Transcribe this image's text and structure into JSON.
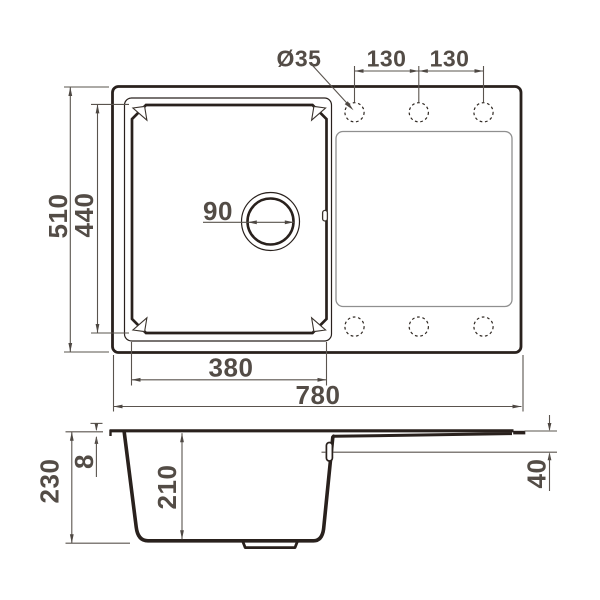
{
  "drawing": {
    "type": "technical-dimension-drawing",
    "subject": "kitchen sink with bowl and drainboard, plan view and section view",
    "colors": {
      "outline": "#29211d",
      "dimension_lines": "#5a544e",
      "dimension_text": "#534c46",
      "drainboard_line": "#8f8f8f",
      "background": "#ffffff"
    },
    "plan_view": {
      "labels": {
        "hole_diameter": "Ø35",
        "hole_spacing_left": "130",
        "hole_spacing_right": "130",
        "overall_width": "510",
        "bowl_inner_width": "440",
        "drain_diameter": "90",
        "bowl_outer_length": "380",
        "overall_length": "780"
      },
      "faucet_holes": {
        "rows": 2,
        "holes_per_row": 3
      }
    },
    "section_view": {
      "labels": {
        "overall_depth": "230",
        "rim_thickness": "8",
        "bowl_depth": "210",
        "drainboard_end_depth": "40"
      }
    }
  }
}
